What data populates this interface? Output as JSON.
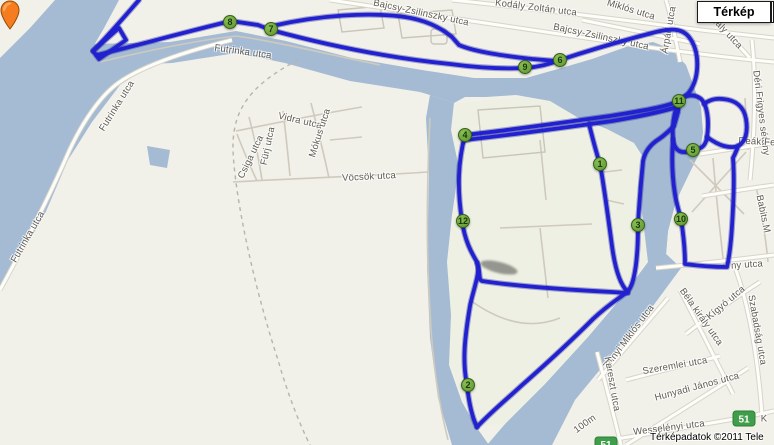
{
  "app": {
    "map_button_label": "Térkép",
    "attribution": "Térképadatok ©2011 Tele"
  },
  "map": {
    "colors": {
      "water": "#a4bbd3",
      "land": "#f1f0e9",
      "route_blue": "#2121cf",
      "marker_green": "#6fa33c",
      "badge_green": "#3f9e49",
      "pin_orange": "#f57d20"
    },
    "route_badges": [
      {
        "label": "51"
      },
      {
        "label": "51"
      }
    ],
    "markers": [
      {
        "n": "1",
        "x": 600,
        "y": 164
      },
      {
        "n": "2",
        "x": 468,
        "y": 385
      },
      {
        "n": "3",
        "x": 638,
        "y": 225
      },
      {
        "n": "4",
        "x": 465,
        "y": 135
      },
      {
        "n": "5",
        "x": 693,
        "y": 150
      },
      {
        "n": "6",
        "x": 560,
        "y": 60
      },
      {
        "n": "7",
        "x": 271,
        "y": 29
      },
      {
        "n": "8",
        "x": 230,
        "y": 22
      },
      {
        "n": "9",
        "x": 525,
        "y": 67
      },
      {
        "n": "10",
        "x": 681,
        "y": 219
      },
      {
        "n": "11",
        "x": 679,
        "y": 101
      },
      {
        "n": "12",
        "x": 463,
        "y": 221
      }
    ],
    "labels": [
      {
        "text": "Futrinka utca",
        "x": 243,
        "y": 52,
        "rot": 8
      },
      {
        "text": "Futrinka utca",
        "x": 117,
        "y": 106,
        "rot": -58
      },
      {
        "text": "Futrinka utca",
        "x": 28,
        "y": 237,
        "rot": -60
      },
      {
        "text": "Vidra utca",
        "x": 300,
        "y": 121,
        "rot": 13
      },
      {
        "text": "Fürj utca",
        "x": 268,
        "y": 146,
        "rot": -78
      },
      {
        "text": "Mókus utca",
        "x": 320,
        "y": 133,
        "rot": -72
      },
      {
        "text": "Csiga utca",
        "x": 251,
        "y": 157,
        "rot": -64
      },
      {
        "text": "Vöcsök utca",
        "x": 369,
        "y": 177,
        "rot": -3
      },
      {
        "text": "Bajcsy-Zsilinszky utca",
        "x": 421,
        "y": 13,
        "rot": 12
      },
      {
        "text": "Kodály Zoltán utca",
        "x": 536,
        "y": 8,
        "rot": 7
      },
      {
        "text": "Bajcsy-Zsilinszky utca",
        "x": 601,
        "y": 37,
        "rot": 12
      },
      {
        "text": "Miklós utca",
        "x": 631,
        "y": 10,
        "rot": 17
      },
      {
        "text": "Árpád utca",
        "x": 669,
        "y": 30,
        "rot": -80
      },
      {
        "text": "mály utca",
        "x": 726,
        "y": 32,
        "rot": 47
      },
      {
        "text": "Déri Frigyes sétány",
        "x": 761,
        "y": 113,
        "rot": 83
      },
      {
        "text": "Deák Fe",
        "x": 757,
        "y": 142,
        "rot": 3
      },
      {
        "text": "Babits M",
        "x": 763,
        "y": 214,
        "rot": 78
      },
      {
        "text": "ny utca",
        "x": 747,
        "y": 265,
        "rot": -4
      },
      {
        "text": "Kígyó utca",
        "x": 726,
        "y": 303,
        "rot": -40
      },
      {
        "text": "Szabadság utca",
        "x": 757,
        "y": 330,
        "rot": 80
      },
      {
        "text": "Béla király utca",
        "x": 701,
        "y": 317,
        "rot": 55
      },
      {
        "text": "Zrínyi Miklós utca",
        "x": 629,
        "y": 337,
        "rot": -53
      },
      {
        "text": "Szeremlei utca",
        "x": 675,
        "y": 366,
        "rot": -10
      },
      {
        "text": "Kereszt utca",
        "x": 612,
        "y": 384,
        "rot": 80
      },
      {
        "text": "Hunyadi János utca",
        "x": 697,
        "y": 387,
        "rot": -15
      },
      {
        "text": "Wesselényi utca",
        "x": 669,
        "y": 428,
        "rot": -7
      },
      {
        "text": "100m",
        "x": 585,
        "y": 424,
        "rot": -36
      },
      {
        "text": "K",
        "x": 764,
        "y": 419,
        "rot": 0
      }
    ]
  }
}
